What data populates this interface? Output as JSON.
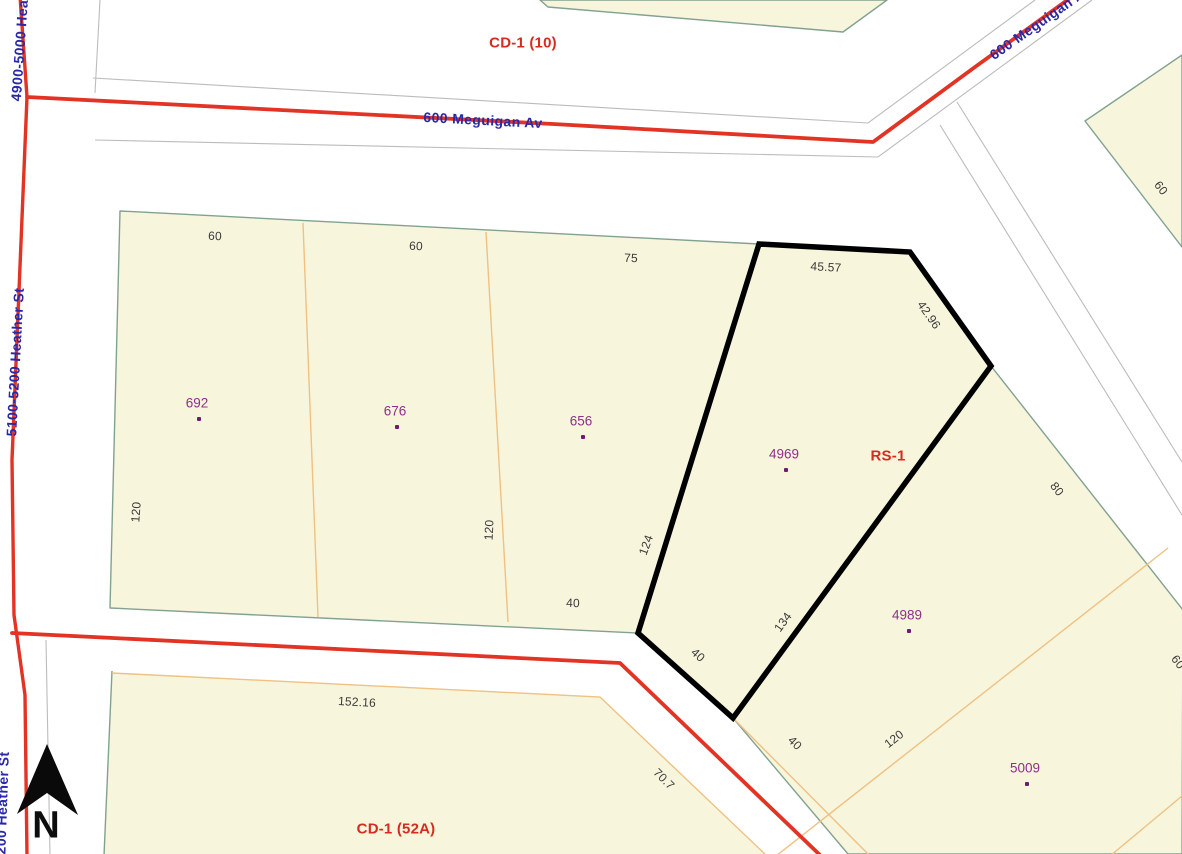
{
  "map": {
    "title": "zoning-parcel-map",
    "colors": {
      "parcel_fill": "#F8F5DD",
      "parcel_edge": "#82A191",
      "lot_line": "#EFC182",
      "road_casing": "#BCBCBC",
      "road_centerline": "#E23324",
      "highlight_outline": "#000000",
      "address_text": "#8E2F8A",
      "address_dot": "#6E1D6B",
      "street_text": "#2929A8",
      "zoning_text": "#D62B1F",
      "dimension_text": "#3A3A3A"
    },
    "zoning_labels": [
      {
        "text": "CD-1 (10)",
        "x": 523,
        "y": 43,
        "rot": 0
      },
      {
        "text": "RS-1",
        "x": 888,
        "y": 456,
        "rot": 0
      },
      {
        "text": "CD-1 (52A)",
        "x": 396,
        "y": 829,
        "rot": 0
      }
    ],
    "street_labels": [
      {
        "text": "600 Meguigan Av",
        "x": 483,
        "y": 120,
        "rot": 3
      },
      {
        "text": "600 Meguigan Av",
        "x": 1040,
        "y": 22,
        "rot": -35
      },
      {
        "text": "4900-5000 Heather St",
        "x": 21,
        "y": 27,
        "rot": -86
      },
      {
        "text": "5100-5200 Heather St",
        "x": 15,
        "y": 362,
        "rot": -87
      },
      {
        "text": "5200 Heather St",
        "x": 2,
        "y": 807,
        "rot": -88
      }
    ],
    "address_labels": [
      {
        "text": "692",
        "x": 197,
        "y": 403
      },
      {
        "text": "676",
        "x": 395,
        "y": 411
      },
      {
        "text": "656",
        "x": 581,
        "y": 421
      },
      {
        "text": "4969",
        "x": 784,
        "y": 454
      },
      {
        "text": "4989",
        "x": 907,
        "y": 615
      },
      {
        "text": "5009",
        "x": 1025,
        "y": 768
      }
    ],
    "dimension_labels": [
      {
        "text": "60",
        "x": 215,
        "y": 236,
        "rot": 2
      },
      {
        "text": "60",
        "x": 416,
        "y": 246,
        "rot": 2
      },
      {
        "text": "75",
        "x": 631,
        "y": 258,
        "rot": 2
      },
      {
        "text": "45.57",
        "x": 826,
        "y": 267,
        "rot": 3
      },
      {
        "text": "42.96",
        "x": 929,
        "y": 315,
        "rot": 55
      },
      {
        "text": "120",
        "x": 136,
        "y": 512,
        "rot": -86
      },
      {
        "text": "120",
        "x": 489,
        "y": 530,
        "rot": -87
      },
      {
        "text": "124",
        "x": 646,
        "y": 545,
        "rot": -70
      },
      {
        "text": "40",
        "x": 573,
        "y": 603,
        "rot": 2
      },
      {
        "text": "40",
        "x": 698,
        "y": 655,
        "rot": 42
      },
      {
        "text": "134",
        "x": 783,
        "y": 622,
        "rot": -54
      },
      {
        "text": "40",
        "x": 795,
        "y": 743,
        "rot": 45
      },
      {
        "text": "120",
        "x": 894,
        "y": 739,
        "rot": -38
      },
      {
        "text": "70.7",
        "x": 664,
        "y": 779,
        "rot": 45
      },
      {
        "text": "152.16",
        "x": 357,
        "y": 702,
        "rot": 3
      },
      {
        "text": "80",
        "x": 1057,
        "y": 489,
        "rot": 52
      },
      {
        "text": "60",
        "x": 1161,
        "y": 188,
        "rot": 52
      },
      {
        "text": "60",
        "x": 1178,
        "y": 662,
        "rot": 52
      }
    ],
    "highlighted_parcel": {
      "address": "4969",
      "zoning": "RS-1"
    },
    "north": {
      "label": "N"
    }
  }
}
